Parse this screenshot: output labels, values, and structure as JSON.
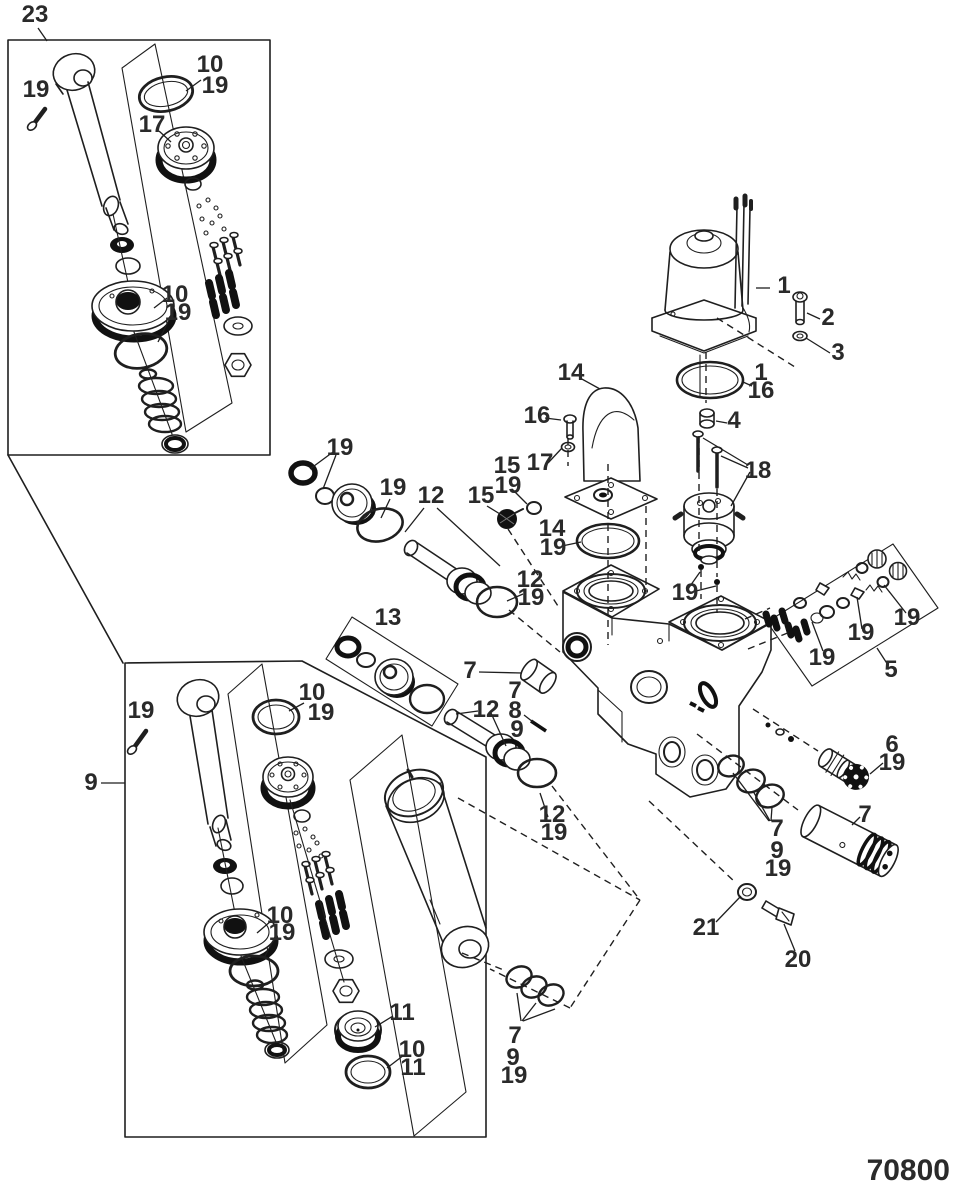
{
  "drawing": {
    "number": "70800"
  },
  "style": {
    "ink": "#1f1f1f",
    "label_color": "#2a2a2a",
    "background": "#ffffff"
  },
  "callouts": [
    {
      "text": "23",
      "x": 35,
      "y": 22
    },
    {
      "text": "19",
      "x": 36,
      "y": 97
    },
    {
      "text": "10",
      "x": 210,
      "y": 72
    },
    {
      "text": "19",
      "x": 215,
      "y": 93
    },
    {
      "text": "17",
      "x": 152,
      "y": 132
    },
    {
      "text": "10",
      "x": 175,
      "y": 302
    },
    {
      "text": "19",
      "x": 178,
      "y": 320
    },
    {
      "text": "19",
      "x": 141,
      "y": 718
    },
    {
      "text": "9",
      "x": 91,
      "y": 790
    },
    {
      "text": "10",
      "x": 312,
      "y": 700
    },
    {
      "text": "19",
      "x": 321,
      "y": 720
    },
    {
      "text": "10",
      "x": 280,
      "y": 923
    },
    {
      "text": "19",
      "x": 282,
      "y": 940
    },
    {
      "text": "11",
      "x": 402,
      "y": 1020
    },
    {
      "text": "10",
      "x": 412,
      "y": 1057
    },
    {
      "text": "11",
      "x": 413,
      "y": 1075
    },
    {
      "text": "19",
      "x": 340,
      "y": 455
    },
    {
      "text": "19",
      "x": 393,
      "y": 495
    },
    {
      "text": "12",
      "x": 431,
      "y": 503
    },
    {
      "text": "12",
      "x": 530,
      "y": 587
    },
    {
      "text": "19",
      "x": 531,
      "y": 605
    },
    {
      "text": "13",
      "x": 388,
      "y": 625
    },
    {
      "text": "15",
      "x": 507,
      "y": 473
    },
    {
      "text": "19",
      "x": 508,
      "y": 493
    },
    {
      "text": "15",
      "x": 481,
      "y": 503
    },
    {
      "text": "17",
      "x": 540,
      "y": 470
    },
    {
      "text": "16",
      "x": 537,
      "y": 423
    },
    {
      "text": "14",
      "x": 571,
      "y": 380
    },
    {
      "text": "14",
      "x": 552,
      "y": 536
    },
    {
      "text": "19",
      "x": 553,
      "y": 555
    },
    {
      "text": "1",
      "x": 784,
      "y": 293
    },
    {
      "text": "2",
      "x": 828,
      "y": 325
    },
    {
      "text": "3",
      "x": 838,
      "y": 360
    },
    {
      "text": "1",
      "x": 761,
      "y": 380
    },
    {
      "text": "16",
      "x": 761,
      "y": 398
    },
    {
      "text": "4",
      "x": 734,
      "y": 428
    },
    {
      "text": "18",
      "x": 758,
      "y": 478
    },
    {
      "text": "19",
      "x": 685,
      "y": 600
    },
    {
      "text": "19",
      "x": 822,
      "y": 665
    },
    {
      "text": "19",
      "x": 861,
      "y": 640
    },
    {
      "text": "19",
      "x": 907,
      "y": 625
    },
    {
      "text": "5",
      "x": 891,
      "y": 677
    },
    {
      "text": "6",
      "x": 892,
      "y": 752
    },
    {
      "text": "19",
      "x": 892,
      "y": 770
    },
    {
      "text": "7",
      "x": 865,
      "y": 822
    },
    {
      "text": "7",
      "x": 777,
      "y": 836
    },
    {
      "text": "9",
      "x": 777,
      "y": 858
    },
    {
      "text": "19",
      "x": 778,
      "y": 876
    },
    {
      "text": "21",
      "x": 706,
      "y": 935
    },
    {
      "text": "20",
      "x": 798,
      "y": 967
    },
    {
      "text": "7",
      "x": 470,
      "y": 678
    },
    {
      "text": "7",
      "x": 515,
      "y": 698
    },
    {
      "text": "8",
      "x": 515,
      "y": 718
    },
    {
      "text": "9",
      "x": 517,
      "y": 737
    },
    {
      "text": "12",
      "x": 486,
      "y": 717
    },
    {
      "text": "12",
      "x": 552,
      "y": 822
    },
    {
      "text": "19",
      "x": 554,
      "y": 840
    },
    {
      "text": "7",
      "x": 515,
      "y": 1043
    },
    {
      "text": "9",
      "x": 513,
      "y": 1065
    },
    {
      "text": "19",
      "x": 514,
      "y": 1083
    }
  ]
}
